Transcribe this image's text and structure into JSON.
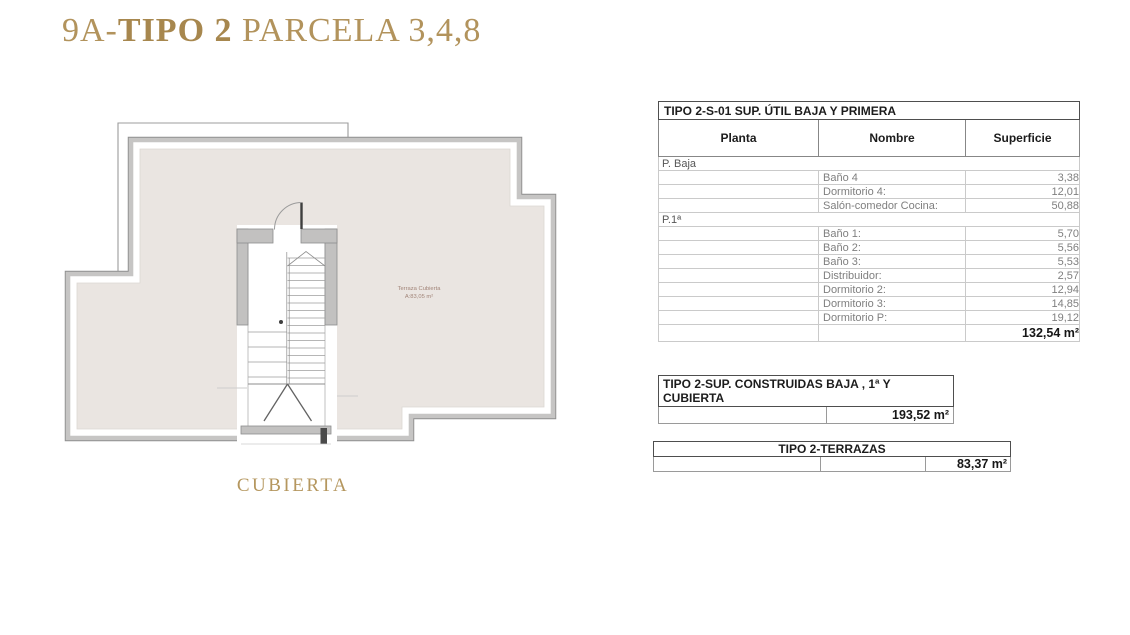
{
  "header": {
    "title_prefix": "9A-",
    "title_bold": "TIPO 2",
    "title_suffix": " PARCELA 3,4,8",
    "accent_color": "#b2935c"
  },
  "plan": {
    "caption": "CUBIERTA",
    "label_line1": "Terraza Cubierta",
    "label_line2": "A:83,05 m²",
    "floor_color": "#eae5e1",
    "wall_color": "#c2c1c0"
  },
  "table_util": {
    "title": "TIPO 2-S-01 SUP. ÚTIL BAJA Y PRIMERA",
    "columns": [
      "Planta",
      "Nombre",
      "Superficie"
    ],
    "sections": [
      {
        "planta": "P. Baja",
        "rows": [
          [
            "Baño 4",
            "3,38"
          ],
          [
            "Dormitorio 4:",
            "12,01"
          ],
          [
            "Salón-comedor Cocina:",
            "50,88"
          ]
        ]
      },
      {
        "planta": "P.1ª",
        "rows": [
          [
            "Baño 1:",
            "5,70"
          ],
          [
            "Baño 2:",
            "5,56"
          ],
          [
            "Baño 3:",
            "5,53"
          ],
          [
            "Distribuidor:",
            "2,57"
          ],
          [
            "Dormitorio 2:",
            "12,94"
          ],
          [
            "Dormitorio 3:",
            "14,85"
          ],
          [
            "Dormitorio P:",
            "19,12"
          ]
        ]
      }
    ],
    "total": "132,54 m²"
  },
  "table_construidas": {
    "title_line1": "TIPO 2-SUP. CONSTRUIDAS  BAJA , 1ª Y",
    "title_line2": "CUBIERTA",
    "total": "193,52 m²"
  },
  "table_terrazas": {
    "title": "TIPO 2-TERRAZAS",
    "total": "83,37 m²"
  }
}
